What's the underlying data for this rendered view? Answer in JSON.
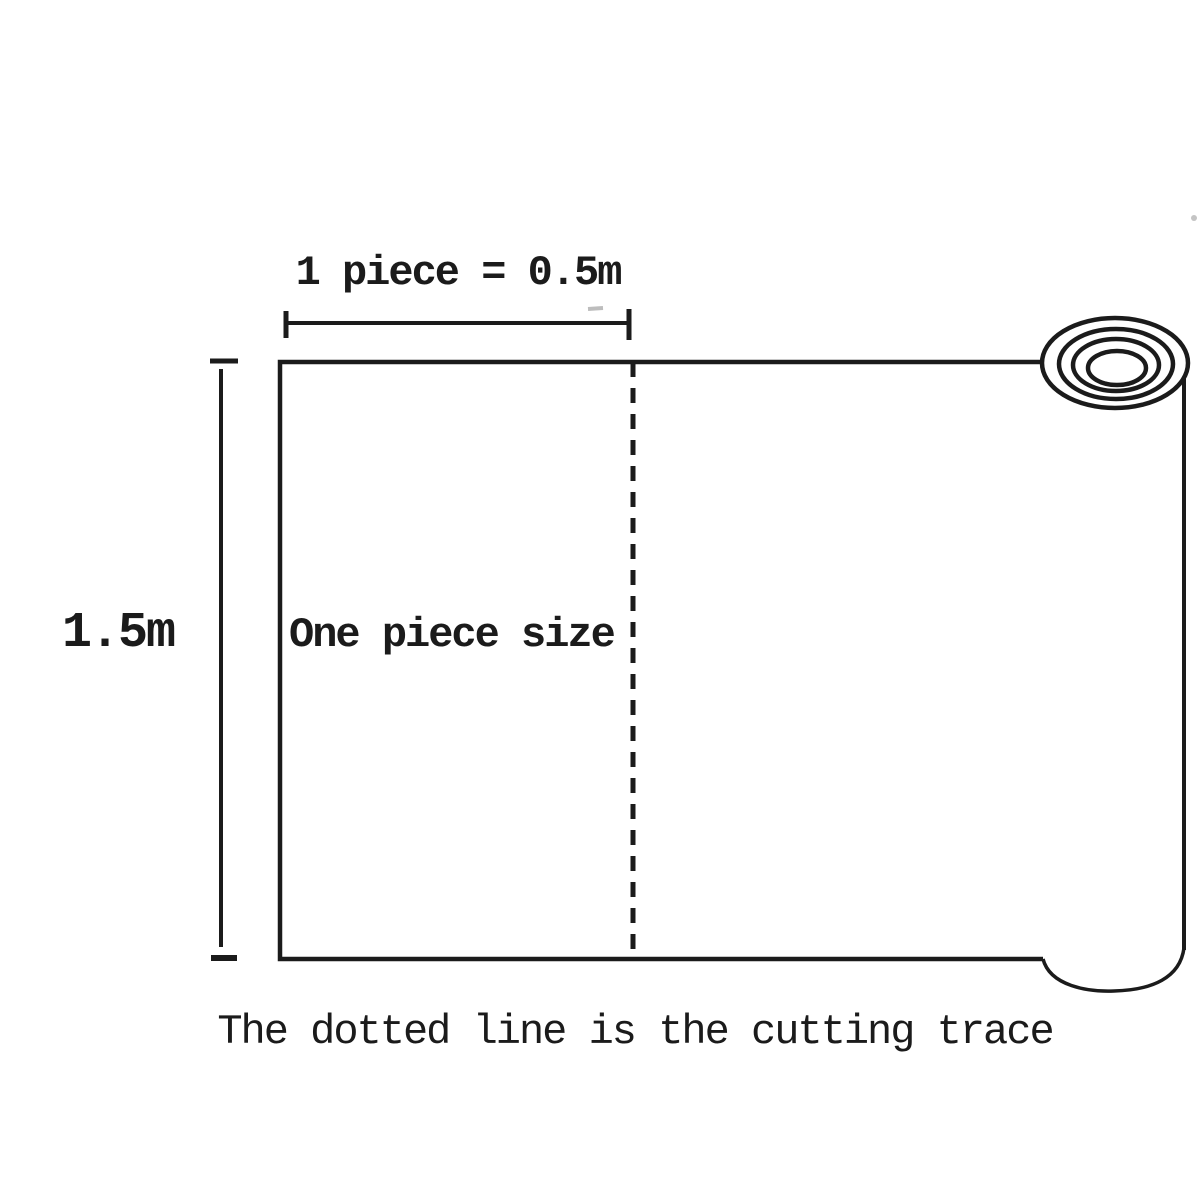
{
  "diagram": {
    "colors": {
      "ink": "#1b1b1b",
      "faint": "#bdbdbd",
      "background": "#ffffff"
    },
    "width_measure": {
      "label": "1 piece = 0.5m",
      "value": "0.5m"
    },
    "height_measure": {
      "label": "1.5m",
      "value": "1.5m"
    },
    "sheet": {
      "label": "One piece size"
    },
    "caption": "The dotted line is the cutting trace",
    "icons": {
      "roll": "fabric-roll-icon"
    }
  }
}
